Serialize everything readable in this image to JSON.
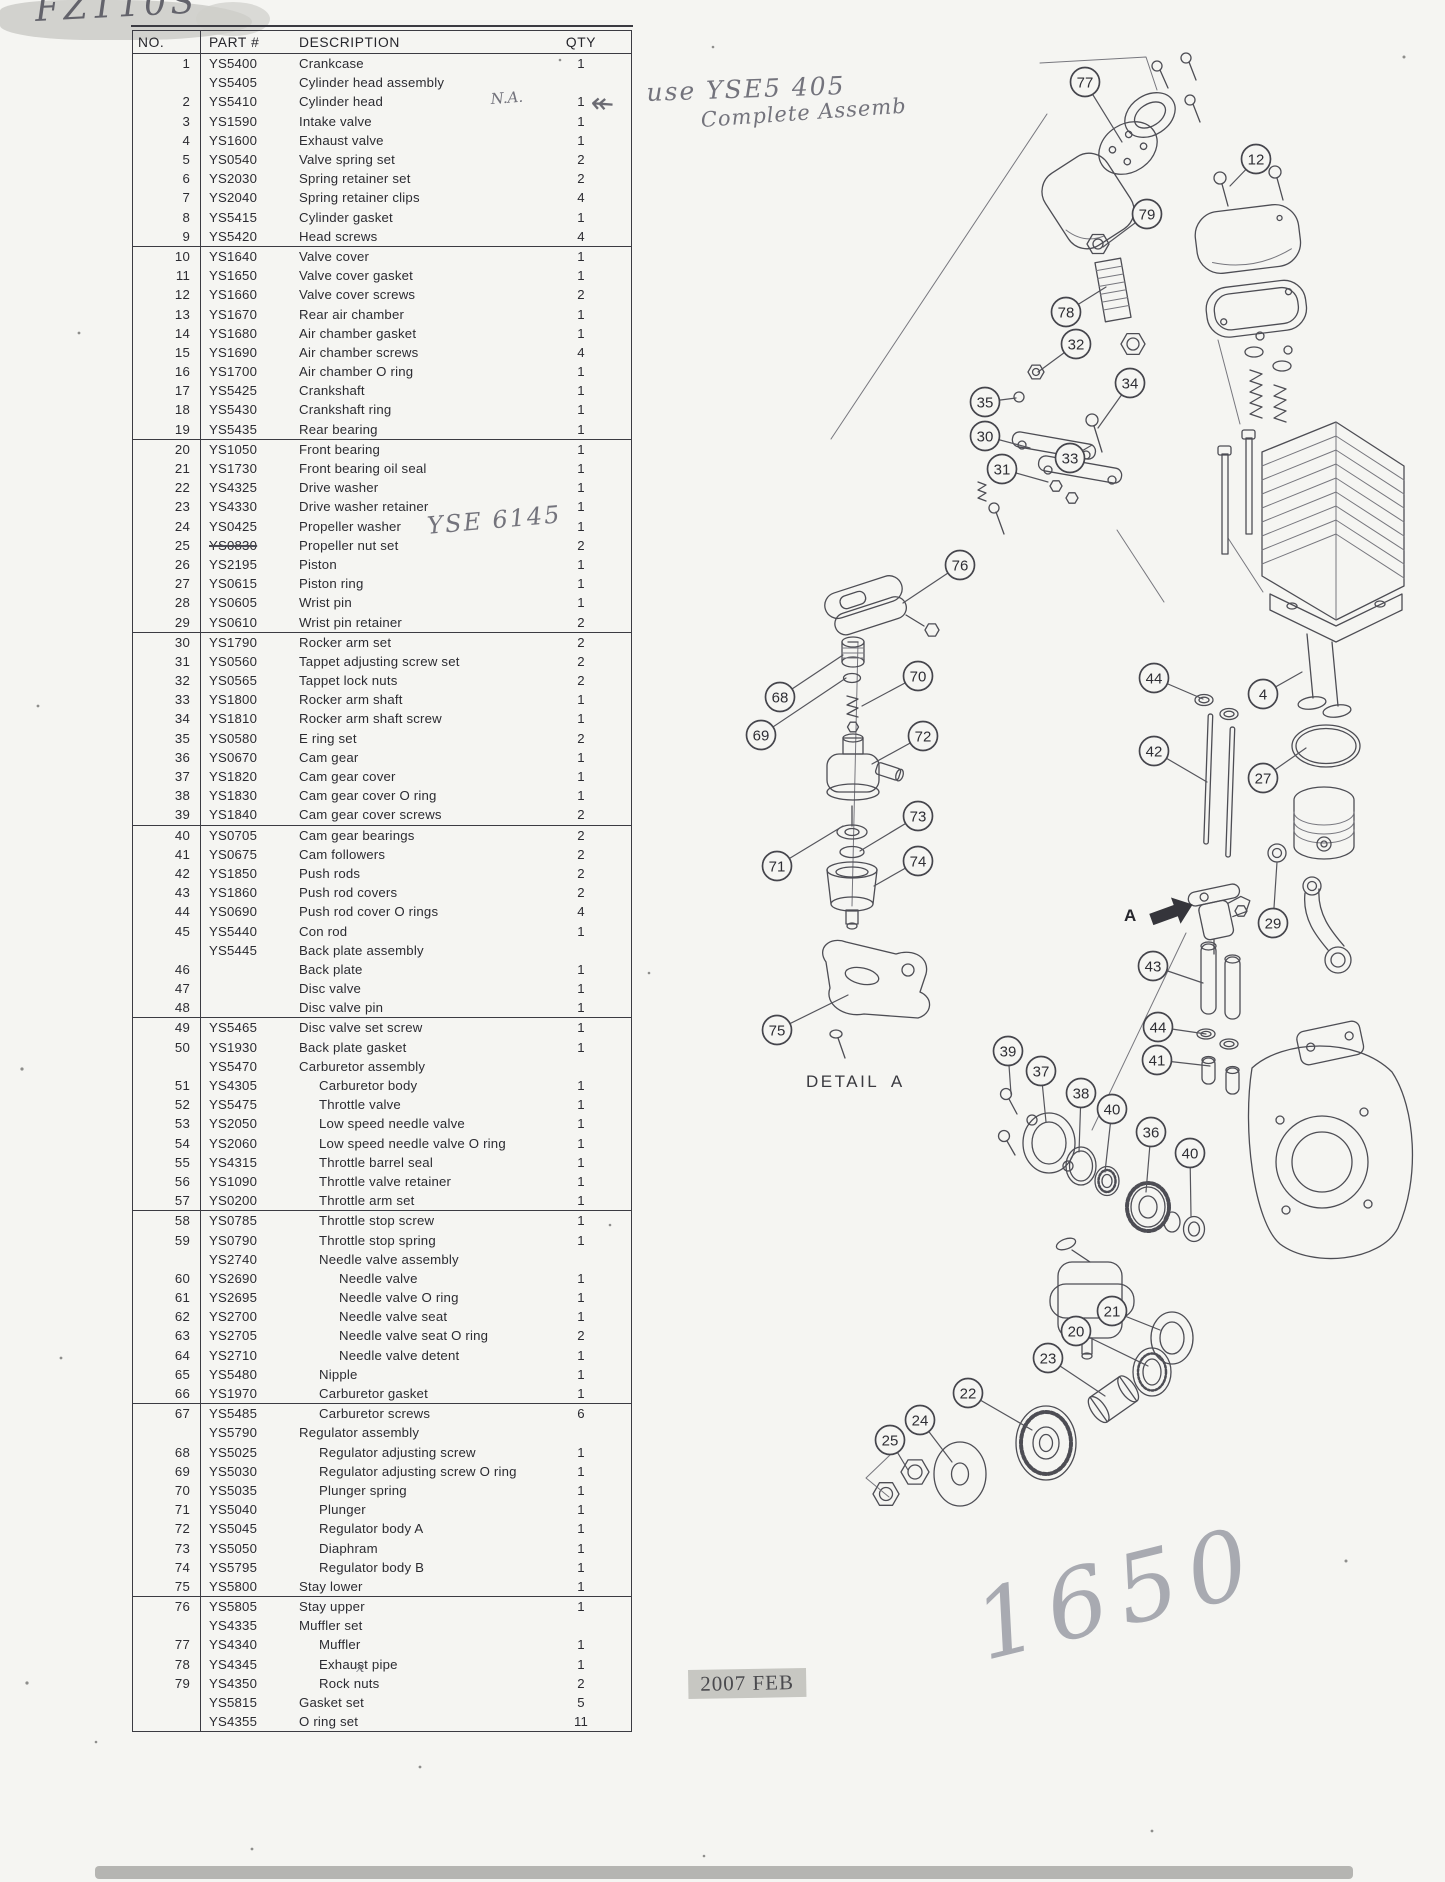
{
  "table": {
    "headers": [
      "NO.",
      "PART #",
      "DESCRIPTION",
      "QTY"
    ],
    "rows": [
      [
        "1",
        "YS5400",
        "Crankcase",
        "1",
        0,
        ""
      ],
      [
        "",
        "YS5405",
        "Cylinder head assembly",
        "",
        0,
        ""
      ],
      [
        "2",
        "YS5410",
        "Cylinder head",
        "1",
        0,
        ""
      ],
      [
        "3",
        "YS1590",
        "Intake valve",
        "1",
        0,
        ""
      ],
      [
        "4",
        "YS1600",
        "Exhaust valve",
        "1",
        0,
        ""
      ],
      [
        "5",
        "YS0540",
        "Valve spring set",
        "2",
        0,
        ""
      ],
      [
        "6",
        "YS2030",
        "Spring retainer set",
        "2",
        0,
        ""
      ],
      [
        "7",
        "YS2040",
        "Spring retainer clips",
        "4",
        0,
        ""
      ],
      [
        "8",
        "YS5415",
        "Cylinder gasket",
        "1",
        0,
        ""
      ],
      [
        "9",
        "YS5420",
        "Head screws",
        "4",
        0,
        ""
      ],
      [
        "10",
        "YS1640",
        "Valve cover",
        "1",
        0,
        "s"
      ],
      [
        "11",
        "YS1650",
        "Valve cover gasket",
        "1",
        0,
        ""
      ],
      [
        "12",
        "YS1660",
        "Valve cover screws",
        "2",
        0,
        ""
      ],
      [
        "13",
        "YS1670",
        "Rear air chamber",
        "1",
        0,
        ""
      ],
      [
        "14",
        "YS1680",
        "Air chamber gasket",
        "1",
        0,
        ""
      ],
      [
        "15",
        "YS1690",
        "Air chamber screws",
        "4",
        0,
        ""
      ],
      [
        "16",
        "YS1700",
        "Air chamber O ring",
        "1",
        0,
        ""
      ],
      [
        "17",
        "YS5425",
        "Crankshaft",
        "1",
        0,
        ""
      ],
      [
        "18",
        "YS5430",
        "Crankshaft ring",
        "1",
        0,
        ""
      ],
      [
        "19",
        "YS5435",
        "Rear bearing",
        "1",
        0,
        ""
      ],
      [
        "20",
        "YS1050",
        "Front bearing",
        "1",
        0,
        "s"
      ],
      [
        "21",
        "YS1730",
        "Front bearing oil seal",
        "1",
        0,
        ""
      ],
      [
        "22",
        "YS4325",
        "Drive washer",
        "1",
        0,
        ""
      ],
      [
        "23",
        "YS4330",
        "Drive washer retainer",
        "1",
        0,
        ""
      ],
      [
        "24",
        "YS0425",
        "Propeller washer",
        "1",
        0,
        ""
      ],
      [
        "25",
        "YS0830",
        "Propeller nut set",
        "2",
        0,
        "k"
      ],
      [
        "26",
        "YS2195",
        "Piston",
        "1",
        0,
        ""
      ],
      [
        "27",
        "YS0615",
        "Piston ring",
        "1",
        0,
        ""
      ],
      [
        "28",
        "YS0605",
        "Wrist pin",
        "1",
        0,
        ""
      ],
      [
        "29",
        "YS0610",
        "Wrist pin retainer",
        "2",
        0,
        ""
      ],
      [
        "30",
        "YS1790",
        "Rocker arm set",
        "2",
        0,
        "s"
      ],
      [
        "31",
        "YS0560",
        "Tappet adjusting screw set",
        "2",
        0,
        ""
      ],
      [
        "32",
        "YS0565",
        "Tappet lock nuts",
        "2",
        0,
        ""
      ],
      [
        "33",
        "YS1800",
        "Rocker arm shaft",
        "1",
        0,
        ""
      ],
      [
        "34",
        "YS1810",
        "Rocker arm shaft screw",
        "1",
        0,
        ""
      ],
      [
        "35",
        "YS0580",
        "E ring set",
        "2",
        0,
        ""
      ],
      [
        "36",
        "YS0670",
        "Cam gear",
        "1",
        0,
        ""
      ],
      [
        "37",
        "YS1820",
        "Cam gear cover",
        "1",
        0,
        ""
      ],
      [
        "38",
        "YS1830",
        "Cam gear cover O ring",
        "1",
        0,
        ""
      ],
      [
        "39",
        "YS1840",
        "Cam gear cover screws",
        "2",
        0,
        ""
      ],
      [
        "40",
        "YS0705",
        "Cam gear bearings",
        "2",
        0,
        "s"
      ],
      [
        "41",
        "YS0675",
        "Cam followers",
        "2",
        0,
        ""
      ],
      [
        "42",
        "YS1850",
        "Push rods",
        "2",
        0,
        ""
      ],
      [
        "43",
        "YS1860",
        "Push rod covers",
        "2",
        0,
        ""
      ],
      [
        "44",
        "YS0690",
        "Push rod cover O rings",
        "4",
        0,
        ""
      ],
      [
        "45",
        "YS5440",
        "Con rod",
        "1",
        0,
        ""
      ],
      [
        "",
        "YS5445",
        "Back plate assembly",
        "",
        0,
        ""
      ],
      [
        "46",
        "",
        "Back plate",
        "1",
        0,
        ""
      ],
      [
        "47",
        "",
        "Disc valve",
        "1",
        0,
        ""
      ],
      [
        "48",
        "",
        "Disc valve pin",
        "1",
        0,
        ""
      ],
      [
        "49",
        "YS5465",
        "Disc valve set screw",
        "1",
        0,
        "s"
      ],
      [
        "50",
        "YS1930",
        "Back plate gasket",
        "1",
        0,
        ""
      ],
      [
        "",
        "YS5470",
        "Carburetor assembly",
        "",
        0,
        ""
      ],
      [
        "51",
        "YS4305",
        "Carburetor body",
        "1",
        1,
        ""
      ],
      [
        "52",
        "YS5475",
        "Throttle valve",
        "1",
        1,
        ""
      ],
      [
        "53",
        "YS2050",
        "Low speed needle valve",
        "1",
        1,
        ""
      ],
      [
        "54",
        "YS2060",
        "Low speed needle valve O ring",
        "1",
        1,
        ""
      ],
      [
        "55",
        "YS4315",
        "Throttle barrel seal",
        "1",
        1,
        ""
      ],
      [
        "56",
        "YS1090",
        "Throttle valve retainer",
        "1",
        1,
        ""
      ],
      [
        "57",
        "YS0200",
        "Throttle arm set",
        "1",
        1,
        ""
      ],
      [
        "58",
        "YS0785",
        "Throttle stop screw",
        "1",
        1,
        "s"
      ],
      [
        "59",
        "YS0790",
        "Throttle stop spring",
        "1",
        1,
        ""
      ],
      [
        "",
        "YS2740",
        "Needle valve assembly",
        "",
        1,
        ""
      ],
      [
        "60",
        "YS2690",
        "Needle valve",
        "1",
        2,
        ""
      ],
      [
        "61",
        "YS2695",
        "Needle valve O ring",
        "1",
        2,
        ""
      ],
      [
        "62",
        "YS2700",
        "Needle valve seat",
        "1",
        2,
        ""
      ],
      [
        "63",
        "YS2705",
        "Needle valve seat O ring",
        "2",
        2,
        ""
      ],
      [
        "64",
        "YS2710",
        "Needle valve detent",
        "1",
        2,
        ""
      ],
      [
        "65",
        "YS5480",
        "Nipple",
        "1",
        1,
        ""
      ],
      [
        "66",
        "YS1970",
        "Carburetor gasket",
        "1",
        1,
        ""
      ],
      [
        "67",
        "YS5485",
        "Carburetor screws",
        "6",
        1,
        "s"
      ],
      [
        "",
        "YS5790",
        "Regulator assembly",
        "",
        0,
        ""
      ],
      [
        "68",
        "YS5025",
        "Regulator adjusting screw",
        "1",
        1,
        ""
      ],
      [
        "69",
        "YS5030",
        "Regulator adjusting screw O ring",
        "1",
        1,
        ""
      ],
      [
        "70",
        "YS5035",
        "Plunger spring",
        "1",
        1,
        ""
      ],
      [
        "71",
        "YS5040",
        "Plunger",
        "1",
        1,
        ""
      ],
      [
        "72",
        "YS5045",
        "Regulator body A",
        "1",
        1,
        ""
      ],
      [
        "73",
        "YS5050",
        "Diaphram",
        "1",
        1,
        ""
      ],
      [
        "74",
        "YS5795",
        "Regulator body B",
        "1",
        1,
        ""
      ],
      [
        "75",
        "YS5800",
        "Stay lower",
        "1",
        0,
        ""
      ],
      [
        "76",
        "YS5805",
        "Stay upper",
        "1",
        0,
        "s"
      ],
      [
        "",
        "YS4335",
        "Muffler set",
        "",
        0,
        ""
      ],
      [
        "77",
        "YS4340",
        "Muffler",
        "1",
        1,
        ""
      ],
      [
        "78",
        "YS4345",
        "Exhaust pipe",
        "1",
        1,
        ""
      ],
      [
        "79",
        "YS4350",
        "Rock nuts",
        "2",
        1,
        ""
      ],
      [
        "",
        "YS5815",
        "Gasket set",
        "5",
        0,
        ""
      ],
      [
        "",
        "YS4355",
        "O ring set",
        "11",
        0,
        ""
      ]
    ]
  },
  "callouts": [
    {
      "n": "77",
      "x": 1085,
      "y": 82,
      "tx": 1122,
      "ty": 142
    },
    {
      "n": "12",
      "x": 1256,
      "y": 159,
      "tx": 1230,
      "ty": 186
    },
    {
      "n": "79",
      "x": 1147,
      "y": 214,
      "tx": 1103,
      "ty": 247
    },
    {
      "n": "78",
      "x": 1066,
      "y": 312,
      "tx": 1106,
      "ty": 287
    },
    {
      "n": "32",
      "x": 1076,
      "y": 344,
      "tx": 1038,
      "ty": 372
    },
    {
      "n": "34",
      "x": 1130,
      "y": 383,
      "tx": 1098,
      "ty": 428
    },
    {
      "n": "35",
      "x": 985,
      "y": 402,
      "tx": 1016,
      "ty": 398
    },
    {
      "n": "30",
      "x": 985,
      "y": 436,
      "tx": 1030,
      "ty": 448
    },
    {
      "n": "31",
      "x": 1002,
      "y": 469,
      "tx": 1048,
      "ty": 482
    },
    {
      "n": "33",
      "x": 1070,
      "y": 458,
      "tx": 1092,
      "ty": 445
    },
    {
      "n": "76",
      "x": 960,
      "y": 565,
      "tx": 903,
      "ty": 603
    },
    {
      "n": "68",
      "x": 780,
      "y": 697,
      "tx": 843,
      "ty": 655
    },
    {
      "n": "69",
      "x": 761,
      "y": 735,
      "tx": 846,
      "ty": 678
    },
    {
      "n": "70",
      "x": 918,
      "y": 676,
      "tx": 862,
      "ty": 706
    },
    {
      "n": "72",
      "x": 923,
      "y": 736,
      "tx": 872,
      "ty": 764
    },
    {
      "n": "71",
      "x": 777,
      "y": 866,
      "tx": 843,
      "ty": 826
    },
    {
      "n": "73",
      "x": 918,
      "y": 816,
      "tx": 860,
      "ty": 851
    },
    {
      "n": "74",
      "x": 918,
      "y": 861,
      "tx": 874,
      "ty": 886
    },
    {
      "n": "75",
      "x": 777,
      "y": 1030,
      "tx": 848,
      "ty": 995
    },
    {
      "n": "44",
      "x": 1154,
      "y": 678,
      "tx": 1203,
      "ty": 699
    },
    {
      "n": "4",
      "x": 1263,
      "y": 694,
      "tx": 1302,
      "ty": 672
    },
    {
      "n": "42",
      "x": 1154,
      "y": 751,
      "tx": 1207,
      "ty": 782
    },
    {
      "n": "27",
      "x": 1263,
      "y": 778,
      "tx": 1306,
      "ty": 748
    },
    {
      "n": "29",
      "x": 1273,
      "y": 923,
      "tx": 1277,
      "ty": 862
    },
    {
      "n": "43",
      "x": 1153,
      "y": 966,
      "tx": 1203,
      "ty": 983
    },
    {
      "n": "44",
      "x": 1158,
      "y": 1027,
      "tx": 1206,
      "ty": 1034
    },
    {
      "n": "41",
      "x": 1157,
      "y": 1060,
      "tx": 1210,
      "ty": 1066
    },
    {
      "n": "39",
      "x": 1008,
      "y": 1051,
      "tx": 1011,
      "ty": 1094
    },
    {
      "n": "37",
      "x": 1041,
      "y": 1071,
      "tx": 1046,
      "ty": 1122
    },
    {
      "n": "38",
      "x": 1081,
      "y": 1093,
      "tx": 1079,
      "ty": 1152
    },
    {
      "n": "40",
      "x": 1112,
      "y": 1109,
      "tx": 1105,
      "ty": 1172
    },
    {
      "n": "36",
      "x": 1151,
      "y": 1132,
      "tx": 1146,
      "ty": 1192
    },
    {
      "n": "40",
      "x": 1190,
      "y": 1153,
      "tx": 1191,
      "ty": 1216
    },
    {
      "n": "21",
      "x": 1112,
      "y": 1311,
      "tx": 1160,
      "ty": 1330
    },
    {
      "n": "20",
      "x": 1076,
      "y": 1331,
      "tx": 1148,
      "ty": 1366
    },
    {
      "n": "23",
      "x": 1048,
      "y": 1358,
      "tx": 1105,
      "ty": 1396
    },
    {
      "n": "22",
      "x": 968,
      "y": 1393,
      "tx": 1032,
      "ty": 1430
    },
    {
      "n": "24",
      "x": 920,
      "y": 1420,
      "tx": 952,
      "ty": 1462
    },
    {
      "n": "25",
      "x": 890,
      "y": 1440,
      "tx": 908,
      "ty": 1470
    }
  ],
  "annotations": [
    {
      "name": "handwritten-model",
      "text": "FZ110S",
      "x": 34,
      "y": -10,
      "cls": "hw hw-title",
      "rot": -3
    },
    {
      "name": "handwritten-na",
      "text": "N.A.",
      "x": 490,
      "y": 90,
      "cls": "hw hw-sm",
      "rot": -4
    },
    {
      "name": "arrow-note-icon",
      "text": "↞",
      "x": 592,
      "y": 86,
      "cls": "hw-arrow",
      "rot": 4
    },
    {
      "name": "handwritten-use-note",
      "text": "use YSE5 405",
      "x": 646,
      "y": 78,
      "cls": "hw hw-note",
      "rot": -2
    },
    {
      "name": "handwritten-use-note-2",
      "text": "Complete Assemb",
      "x": 700,
      "y": 108,
      "cls": "hw hw-note2",
      "rot": -4
    },
    {
      "name": "handwritten-part-sub",
      "text": "YSE 6145",
      "x": 426,
      "y": 512,
      "cls": "hw hw-md",
      "rot": -5
    },
    {
      "name": "handwritten-x-mark",
      "text": "x",
      "x": 356,
      "y": 1658,
      "cls": "hw hw-sm",
      "rot": 0
    },
    {
      "name": "detail-a-label",
      "text": "DETAIL A",
      "x": 806,
      "y": 1072,
      "cls": "dlabel",
      "rot": 0
    },
    {
      "name": "detail-arrow-label",
      "text": "A",
      "x": 1124,
      "y": 906,
      "cls": "alabel",
      "rot": 0
    },
    {
      "name": "date-stamp",
      "text": "2007 FEB",
      "x": 688,
      "y": 1670,
      "cls": "stamp",
      "rot": -1
    },
    {
      "name": "handwritten-price",
      "text": "1650",
      "x": 964,
      "y": 1576,
      "cls": "hw hw-price",
      "rot": -14
    }
  ]
}
